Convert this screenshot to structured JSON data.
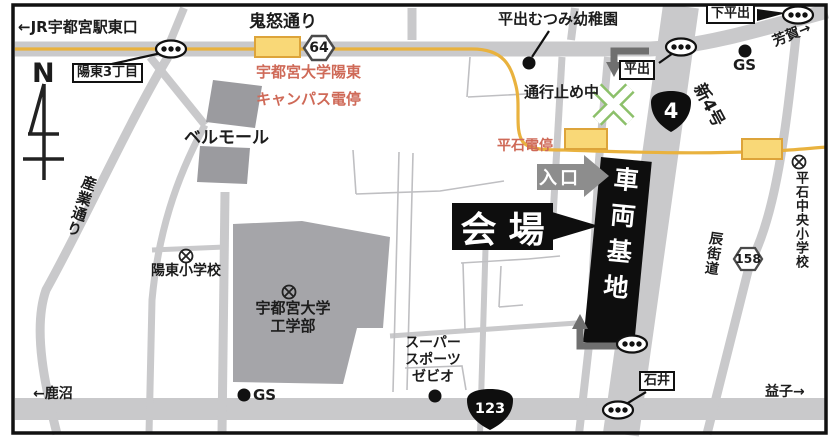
{
  "labels": {
    "jr_station_exit": "←JR宇都宮駅東口",
    "kinu_dori": "鬼怒通り",
    "yoto_3chome": "陽東3丁目",
    "compass_north": "N",
    "campus_stop_line1": "宇都宮大学陽東",
    "campus_stop_line2": "キャンパス電停",
    "bell_mall": "ベルモール",
    "sangyo_dori": "産業通り",
    "yoto_elementary": "陽東小学校",
    "univ_line1": "宇都宮大学",
    "univ_line2": "工学部",
    "kanuma": "←鹿沼",
    "gs_south": "GS",
    "gs_north": "GS",
    "xebio_line1": "スーパー",
    "xebio_line2": "スポーツ",
    "xebio_line3": "ゼビオ",
    "ishii": "石井",
    "mashiko": "益子→",
    "tatsu_kaido": "辰街道",
    "hiraishi_chuo_elementary": "平石中央小学校",
    "shin_4go": "新4号",
    "hiraide": "平出",
    "shimo_hiraide": "下平出",
    "haga": "芳賀→",
    "hiraide_mutsumi_kindergarten": "平出むつみ幼稚園",
    "road_closed": "通行止め中",
    "hiraishi_tram_stop": "平石電停",
    "entrance": "入口",
    "venue": "会場",
    "rail_depot": "車両基地"
  },
  "shields": {
    "prefectural_64": "64",
    "national_4": "4",
    "prefectural_158": "158",
    "national_123": "123"
  },
  "icons": {
    "school_symbol": "circle-with-x",
    "traffic_light": "oval-with-three-dots",
    "poi_dot": "black-circle"
  },
  "colors": {
    "road_gray": "#c9c9cb",
    "building_gray": "#a0a0a4",
    "tram_line_yellow": "#e9b23e",
    "tram_stop_fill": "#f9d877",
    "tram_stop_border": "#dda43a",
    "red_text": "#cf6a58",
    "closed_x_green": "#8cc06a",
    "arrow_gray": "#8d8d8d",
    "ink_black": "#111111"
  }
}
